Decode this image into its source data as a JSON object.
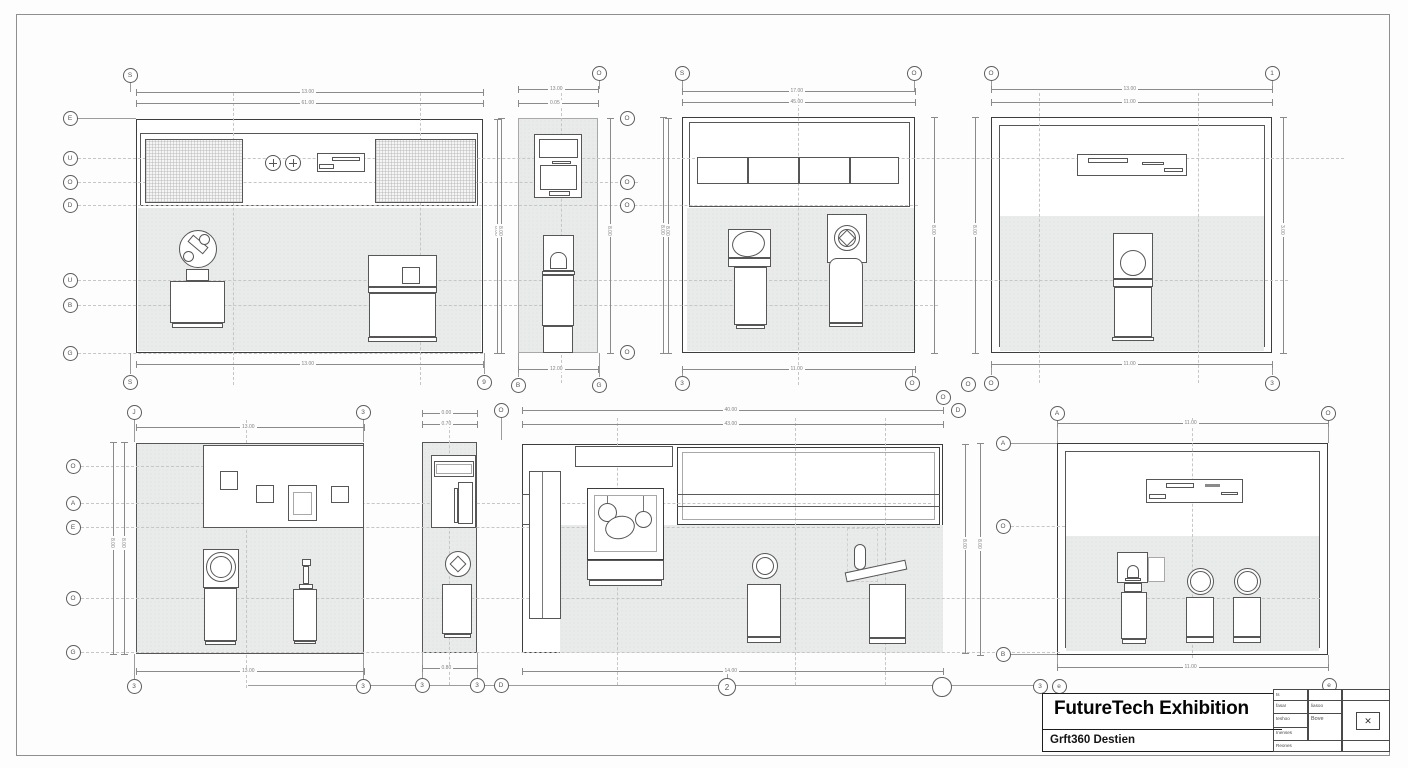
{
  "sheet": {
    "title_block": {
      "title": "FutureTech Exhibition",
      "subtitle": "Grft360 Destien",
      "table": {
        "r1c1": "ts",
        "r2c1": "fasar",
        "r2c2": "liasoo",
        "r3c1": "teshoo",
        "r3c2": "Bove",
        "r4c1": "Inenses",
        "r5c1": "Reones"
      },
      "north_icon": "✕"
    },
    "grid_bubbles": {
      "a_top": [
        "S"
      ],
      "a_left": [
        "E",
        "U",
        "O",
        "D",
        "U",
        "B",
        "G"
      ],
      "a_bottom": [
        "S",
        "9"
      ],
      "b_top": [
        "O"
      ],
      "b_right": [
        "O",
        "O",
        "O",
        "O"
      ],
      "b_bottom": [
        "B",
        "G"
      ],
      "c_top": [
        "S",
        "O"
      ],
      "c_bottom": [
        "3",
        "O"
      ],
      "c_extra": [
        "O",
        "D",
        "O"
      ],
      "d_top": [
        "O",
        "1"
      ],
      "d_bottom": [
        "O",
        "3"
      ],
      "e_top": [
        "J",
        "3"
      ],
      "e_left": [
        "O",
        "A",
        "E",
        "O",
        "G"
      ],
      "e_bottom": [
        "3",
        "3"
      ],
      "f_top": [
        "O"
      ],
      "f_bottom": [
        "3",
        "3",
        "D"
      ],
      "g_bottom": [
        "2"
      ],
      "g_plain": [
        ""
      ],
      "h_top": [
        "A",
        "O"
      ],
      "h_left": [
        "A",
        "O",
        "B"
      ],
      "h_title": [
        "3",
        "e",
        "e"
      ]
    },
    "dimensions": {
      "a_top1": "13.00",
      "a_top2": "61.00",
      "a_bottom": "13.00",
      "a_right": "8.00",
      "b_top1": "13.00",
      "b_top2": "0.05",
      "b_bottom": "12.00",
      "b_left": "8.00",
      "b_right1": "8.00",
      "b_right2": "8.00",
      "c_top1": "17.00",
      "c_top2": "45.00",
      "c_bottom": "11.00",
      "c_left": "8.00",
      "c_right": "8.00",
      "d_top1": "13.00",
      "d_top2": "11.00",
      "d_bottom": "11.00",
      "d_left": "8.00",
      "d_right": "3.00",
      "e_top": "13.00",
      "e_bottom": "13.00",
      "e_left1": "8.00",
      "e_left2": "8.00",
      "f_top1": "0.00",
      "f_top2": "0.70",
      "f_bottom": "0.80",
      "g_top1": "40.00",
      "g_top2": "43.00",
      "g_bottom": "14.00",
      "g_right": "8.00",
      "h_top": "11.00",
      "h_bottom": "11.00",
      "h_left": "8.00"
    }
  }
}
